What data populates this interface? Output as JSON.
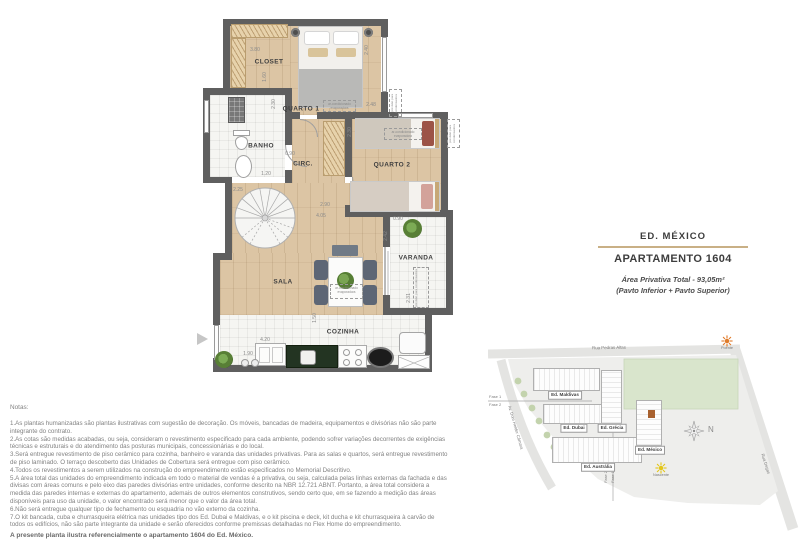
{
  "title_block": {
    "building": "ED. MÉXICO",
    "apartment": "APARTAMENTO 1604",
    "area_line": "Área Privativa Total - 93,05m²",
    "pavement_line": "(Pavto Inferior + Pavto Superior)",
    "divider_color": "#c9b086"
  },
  "floor_plan": {
    "room_labels": [
      {
        "text": "CLOSET",
        "x": 74,
        "y": 57
      },
      {
        "text": "QUARTO 1",
        "x": 106,
        "y": 104
      },
      {
        "text": "BANHO",
        "x": 66,
        "y": 141
      },
      {
        "text": "CIRC.",
        "x": 108,
        "y": 159
      },
      {
        "text": "QUARTO 2",
        "x": 197,
        "y": 160
      },
      {
        "text": "SALA",
        "x": 88,
        "y": 277
      },
      {
        "text": "VARANDA",
        "x": 221,
        "y": 253
      },
      {
        "text": "COZINHA",
        "x": 148,
        "y": 327
      }
    ],
    "dimensions": [
      {
        "text": "3.80",
        "x": 60,
        "y": 45,
        "rot": "h"
      },
      {
        "text": "1.60",
        "x": 70,
        "y": 72,
        "rot": "v"
      },
      {
        "text": "2.40",
        "x": 172,
        "y": 45,
        "rot": "v"
      },
      {
        "text": "2.48",
        "x": 176,
        "y": 100,
        "rot": "h"
      },
      {
        "text": "2.30",
        "x": 79,
        "y": 99,
        "rot": "v"
      },
      {
        "text": "1.20",
        "x": 71,
        "y": 169,
        "rot": "h"
      },
      {
        "text": "0.90",
        "x": 95,
        "y": 149,
        "rot": "h"
      },
      {
        "text": "2.30",
        "x": 155,
        "y": 127,
        "rot": "v"
      },
      {
        "text": "2.25",
        "x": 43,
        "y": 185,
        "rot": "h"
      },
      {
        "text": "2.90",
        "x": 130,
        "y": 200,
        "rot": "h"
      },
      {
        "text": "4.05",
        "x": 126,
        "y": 211,
        "rot": "h"
      },
      {
        "text": "0.90",
        "x": 203,
        "y": 214,
        "rot": "h"
      },
      {
        "text": "2.42",
        "x": 191,
        "y": 231,
        "rot": "v"
      },
      {
        "text": "2.31",
        "x": 214,
        "y": 293,
        "rot": "v"
      },
      {
        "text": "1.50",
        "x": 120,
        "y": 313,
        "rot": "v"
      },
      {
        "text": "4.20",
        "x": 70,
        "y": 335,
        "rot": "h"
      },
      {
        "text": "1.90",
        "x": 53,
        "y": 349,
        "rot": "h"
      }
    ],
    "ac_label": {
      "line1": "ar-condicionado",
      "line2": "evaporadora"
    },
    "condenser_label": "previsão para condensadora"
  },
  "site_map": {
    "streets": [
      {
        "name": "Rua Pedras Altas"
      },
      {
        "name": "Av. Dom Helder Câmara"
      },
      {
        "name": "Rua Degas"
      }
    ],
    "buildings": [
      {
        "name": "Ed. Maldivas",
        "x": 45,
        "y": 35,
        "w": 67,
        "h": 23,
        "lx": 77,
        "ly": 62
      },
      {
        "name": "Ed. Dubai",
        "x": 55,
        "y": 71,
        "w": 59,
        "h": 20,
        "lx": 86,
        "ly": 95
      },
      {
        "name": "Ed. Grécia",
        "x": 113,
        "y": 37,
        "w": 21,
        "h": 54,
        "lx": 124,
        "ly": 95
      },
      {
        "name": "Ed. Austrália",
        "x": 64,
        "y": 104,
        "w": 90,
        "h": 26,
        "lx": 110,
        "ly": 134
      },
      {
        "name": "Ed. México",
        "x": 148,
        "y": 67,
        "w": 26,
        "h": 46,
        "lx": 162,
        "ly": 117,
        "highlight": true
      }
    ],
    "highlight_color": "#a8612f",
    "suns": [
      {
        "label": "Poente",
        "color": "#e07b2a",
        "x": 233,
        "y": 1
      },
      {
        "label": "Nascente",
        "color": "#e3c619",
        "x": 167,
        "y": 128
      }
    ],
    "phases": {
      "fase1": "Fase 1",
      "fase2": "Fase 2"
    },
    "north_label": "N"
  },
  "notes": {
    "heading": "Notas:",
    "items": [
      "1.As plantas humanizadas são plantas ilustrativas com sugestão de decoração. Os móveis, bancadas de madeira, equipamentos e divisórias não são parte integrante do contrato.",
      "2.As cotas são medidas acabadas, ou seja, consideram o revestimento especificado para cada ambiente, podendo sofrer variações decorrentes de exigências técnicas e estruturais e do atendimento das posturas municipais, concessionárias e do local.",
      "3.Será entregue revestimento de piso cerâmico para cozinha, banheiro e varanda das unidades privativas. Para as salas e quartos, será entregue revestimento de piso laminado. O terraço descoberto das Unidades de Cobertura será entregue com piso cerâmico.",
      "4.Todos os revestimentos a serem utilizados na construção do empreendimento estão especificados no Memorial Descritivo.",
      "5.A área total das unidades do empreendimento indicada em todo o material de vendas é a privativa, ou seja, calculada pelas linhas externas da fachada e das divisas com áreas comuns e pelo eixo das paredes divisórias entre unidades, conforme descrito na NBR 12.721 ABNT. Portanto, a área total considera a medida das paredes internas e externas do apartamento, ademais de outros elementos construtivos, sendo certo que, em se fazendo a medição das áreas disponíveis para uso da unidade, o valor encontrado será menor que o valor da área total.",
      "6.Não será entregue qualquer tipo de fechamento ou esquadria no vão externo da cozinha.",
      "7.O kit bancada, cuba e churrasqueira elétrica nas unidades tipo dos Ed. Dubai e Maldivas, e o kit piscina e deck, kit ducha e kit churrasqueira à carvão de todos os edifícios, não são parte integrante da unidade e serão oferecidos conforme premissas detalhadas no Flex Home do empreendimento."
    ],
    "footer": "A presente planta ilustra referencialmente o apartamento 1604 do Ed. México."
  }
}
